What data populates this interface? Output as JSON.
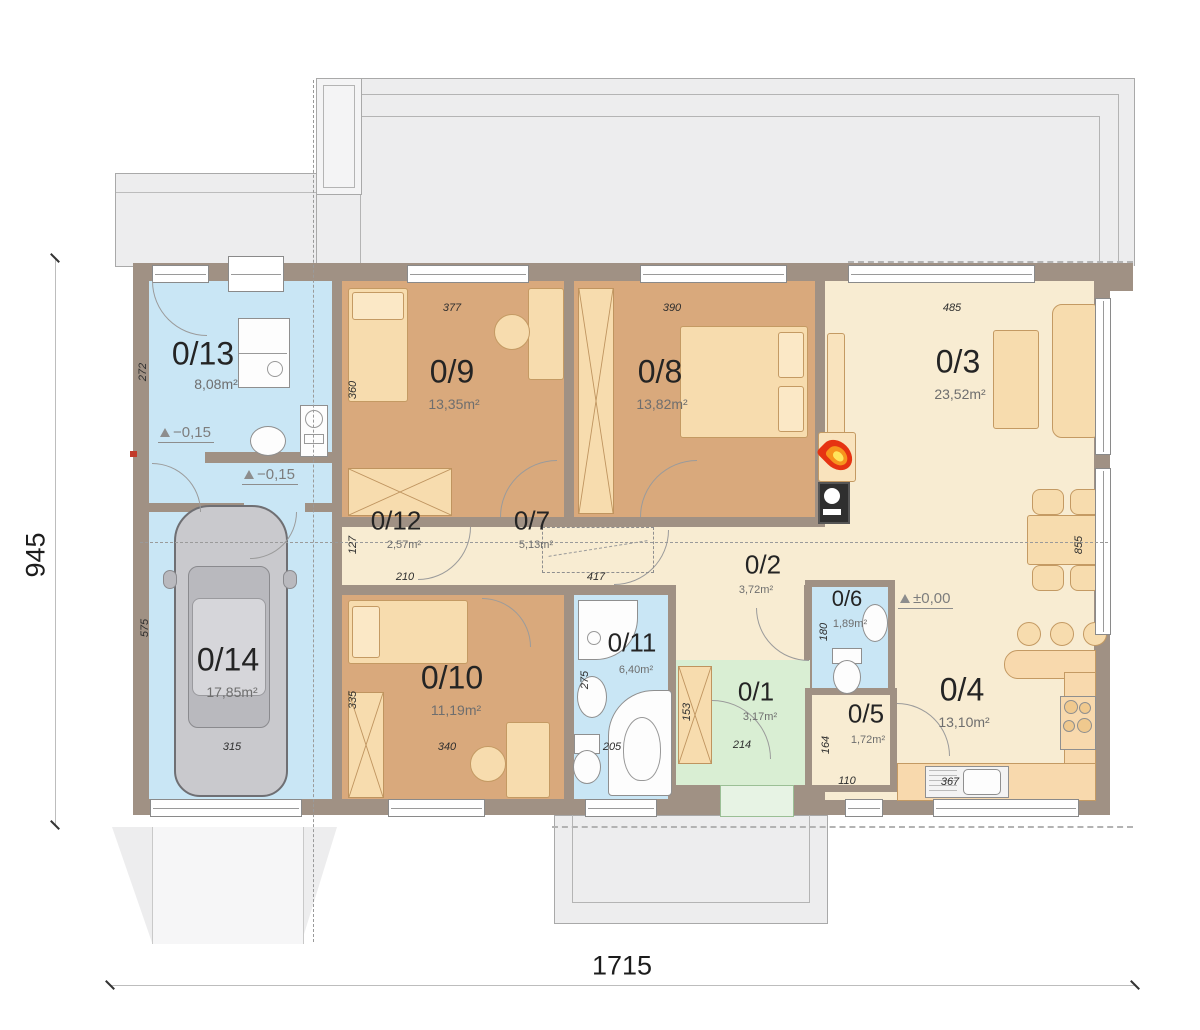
{
  "title": "house-ground-floor-plan",
  "rooms": {
    "r1": {
      "number": "0/1",
      "area": "3,17m²"
    },
    "r2": {
      "number": "0/2",
      "area": "3,72m²"
    },
    "r3": {
      "number": "0/3",
      "area": "23,52m²"
    },
    "r4": {
      "number": "0/4",
      "area": "13,10m²"
    },
    "r5": {
      "number": "0/5",
      "area": "1,72m²"
    },
    "r6": {
      "number": "0/6",
      "area": "1,89m²"
    },
    "r7": {
      "number": "0/7",
      "area": "5,13m²"
    },
    "r8": {
      "number": "0/8",
      "area": "13,82m²"
    },
    "r9": {
      "number": "0/9",
      "area": "13,35m²"
    },
    "r10": {
      "number": "0/10",
      "area": "11,19m²"
    },
    "r11": {
      "number": "0/11",
      "area": "6,40m²"
    },
    "r12": {
      "number": "0/12",
      "area": "2,57m²"
    },
    "r13": {
      "number": "0/13",
      "area": "8,08m²"
    },
    "r14": {
      "number": "0/14",
      "area": "17,85m²"
    }
  },
  "dims": {
    "d377": "377",
    "d390": "390",
    "d485": "485",
    "d360": "360",
    "d272": "272",
    "d127": "127",
    "d210": "210",
    "d417": "417",
    "d855": "855",
    "d575": "575",
    "d315": "315",
    "d335": "335",
    "d340": "340",
    "d275": "275",
    "d205": "205",
    "d153": "153",
    "d214": "214",
    "d180": "180",
    "d164": "164",
    "d110": "110",
    "d367": "367"
  },
  "overall": {
    "width": "1715",
    "height": "945"
  },
  "levels": {
    "entry": "−0,15",
    "vestibule": "−0,15",
    "main": "±0,00"
  },
  "colors": {
    "wall": "#a09184",
    "wet_room": "#c9e6f5",
    "bedroom": "#d9a97c",
    "living": "#f8ecd2",
    "entry": "#d9eed3",
    "roof": "#ededee",
    "flame": "#e63312"
  }
}
